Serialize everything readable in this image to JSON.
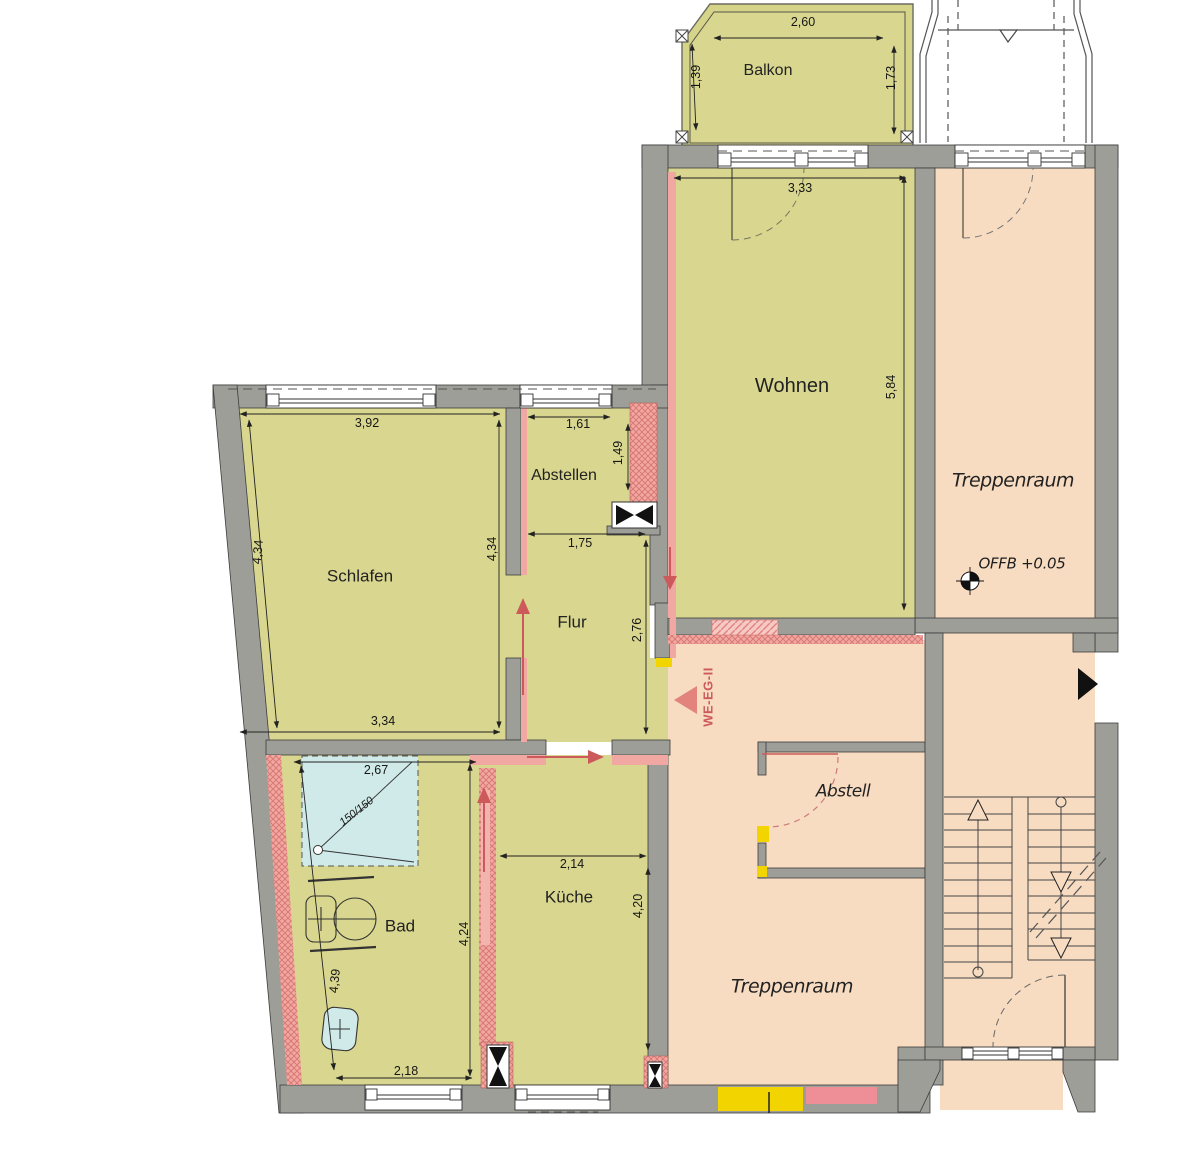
{
  "rooms": {
    "balkon": "Balkon",
    "wohnen": "Wohnen",
    "schlafen": "Schlafen",
    "abstellen": "Abstellen",
    "flur": "Flur",
    "kueche": "Küche",
    "bad": "Bad",
    "abstell": "Abstell",
    "treppenraum_upper": "Treppenraum",
    "treppenraum_lower": "Treppenraum"
  },
  "annotations": {
    "level_mark": "OFFB +0.05",
    "apartment_entry": "WE-EG-II",
    "shower_size": "150/150"
  },
  "dims": {
    "balkon_width": "2,60",
    "balkon_left": "1,39",
    "balkon_right": "1,73",
    "wohnen_width": "3,33",
    "wohnen_depth": "5,84",
    "schlafen_top": "3,92",
    "schlafen_left": "4,34",
    "schlafen_right": "4,34",
    "schlafen_bottom": "3,34",
    "abstellen_width": "1,61",
    "abstellen_depth": "1,49",
    "flur_width": "1,75",
    "flur_depth": "2,76",
    "kueche_width": "2,14",
    "kueche_right": "4,20",
    "kueche_left": "4,24",
    "bad_top": "2,67",
    "bad_left": "4,39",
    "bad_bottom": "2,18"
  },
  "colors": {
    "apartment_floor": "#d9d78f",
    "common_floor": "#f8dcc2",
    "wall_gray": "#9d9e97",
    "new_wall_pink": "#f2a8a2",
    "demolition_yellow": "#f2d500",
    "shower_blue": "#cfeae8",
    "marker_red": "#cc5a5a"
  }
}
